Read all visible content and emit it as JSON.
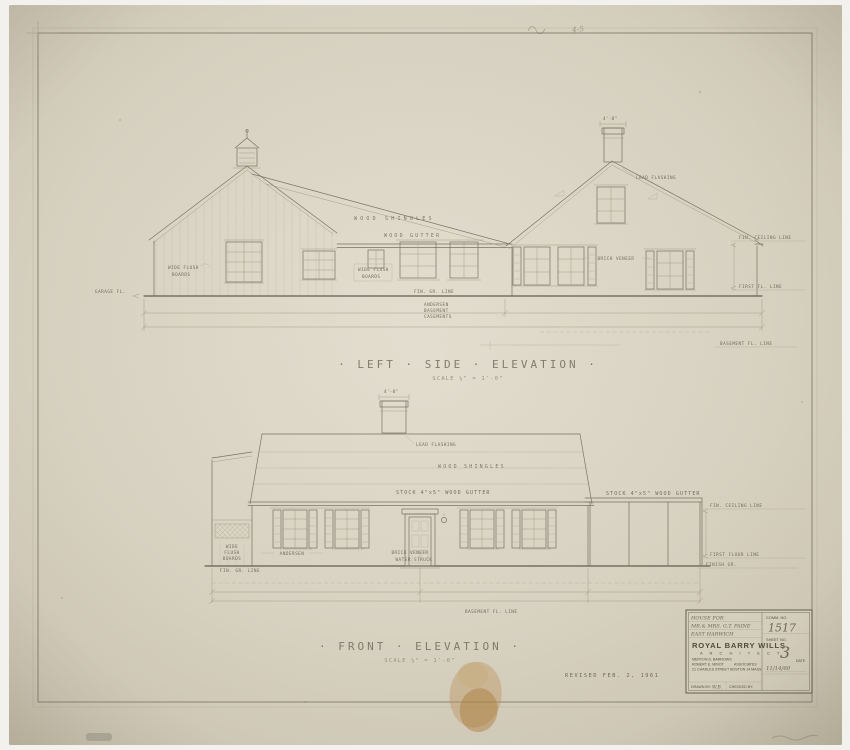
{
  "colors": {
    "photo_background": "#f3f1ed",
    "paper": "#dcd6c6",
    "paper_edge": "#c9c2ae",
    "pencil": "#7b7365",
    "pencil_dark": "#655d4f",
    "pencil_light": "#a39a86",
    "tape_stain": "#b98f50"
  },
  "titles": {
    "left": {
      "label": "· LEFT · SIDE · ELEVATION ·",
      "scale": "SCALE ¼\" = 1'-0\""
    },
    "front": {
      "label": "· FRONT · ELEVATION ·",
      "scale": "SCALE ¼\" = 1'-0\""
    }
  },
  "left_elev": {
    "garage_boards": [
      "WIDE FLUSH",
      "BOARDS"
    ],
    "wood_shingles": "WOOD SHINGLES",
    "wood_gutter": "WOOD GUTTER",
    "ell_boards": [
      "WIDE FLUSH",
      "BOARDS"
    ],
    "fin_gr": "FIN. GR. LINE",
    "andersen": [
      "ANDERSEN",
      "BASEMENT",
      "CASEMENTS"
    ],
    "lead_flashing": "LEAD FLASHING",
    "brick_veneer": "BRICK VENEER",
    "fin_ceiling": "FIN. CEILING LINE",
    "first_fl": "FIRST FL. LINE",
    "basement_fl": "BASEMENT FL. LINE",
    "garage_fl": "GARAGE FL.",
    "chimney_dim": "4'-0\""
  },
  "front_elev": {
    "lead_flashing": "LEAD FLASHING",
    "wood_shingles": "WOOD SHINGLES",
    "gutter_left": "STOCK 4\"x5\" WOOD GUTTER",
    "gutter_right": "STOCK 4\"x5\" WOOD GUTTER",
    "garage_boards": [
      "WIDE",
      "FLUSH",
      "BOARDS"
    ],
    "fin_gr": "FIN. GR. LINE",
    "andersen": "ANDERSEN",
    "brick_veneer": [
      "BRICK VENEER",
      "WATER STRUCK"
    ],
    "fin_ceiling": "FIN. CEILING LINE",
    "first_floor": "FIRST FLOOR LINE",
    "finish_gr": "FINISH GR.",
    "basement_fl": "BASEMENT FL. LINE",
    "chimney_dim": "4'-0\""
  },
  "notes": {
    "revised": "REVISED  FEB. 2, 1961",
    "scribble": "4-5"
  },
  "title_block": {
    "project": [
      "HOUSE FOR",
      "MR.& MRS. G.T. PAINE",
      "EAST HARWICH"
    ],
    "firm": "ROYAL BARRY WILLS",
    "profession": "A R C H I T E C T",
    "associate1": "MERTON D. BARROWS",
    "associate2": "ROBERT E. MINOT",
    "associates": "ASSOCIATES",
    "address": "21 CHARLES STREET BOSTON 14 MASS.",
    "drawn_by_label": "DRAWN BY:",
    "drawn_by": "W.B.",
    "checked_by_label": "CHECKED BY:",
    "comm_label": "COMM. NO.",
    "comm_no": "1517",
    "sheet_label": "SHEET NO.",
    "sheet_no": "3",
    "date_label": "DATE",
    "date": "11/14/60"
  }
}
